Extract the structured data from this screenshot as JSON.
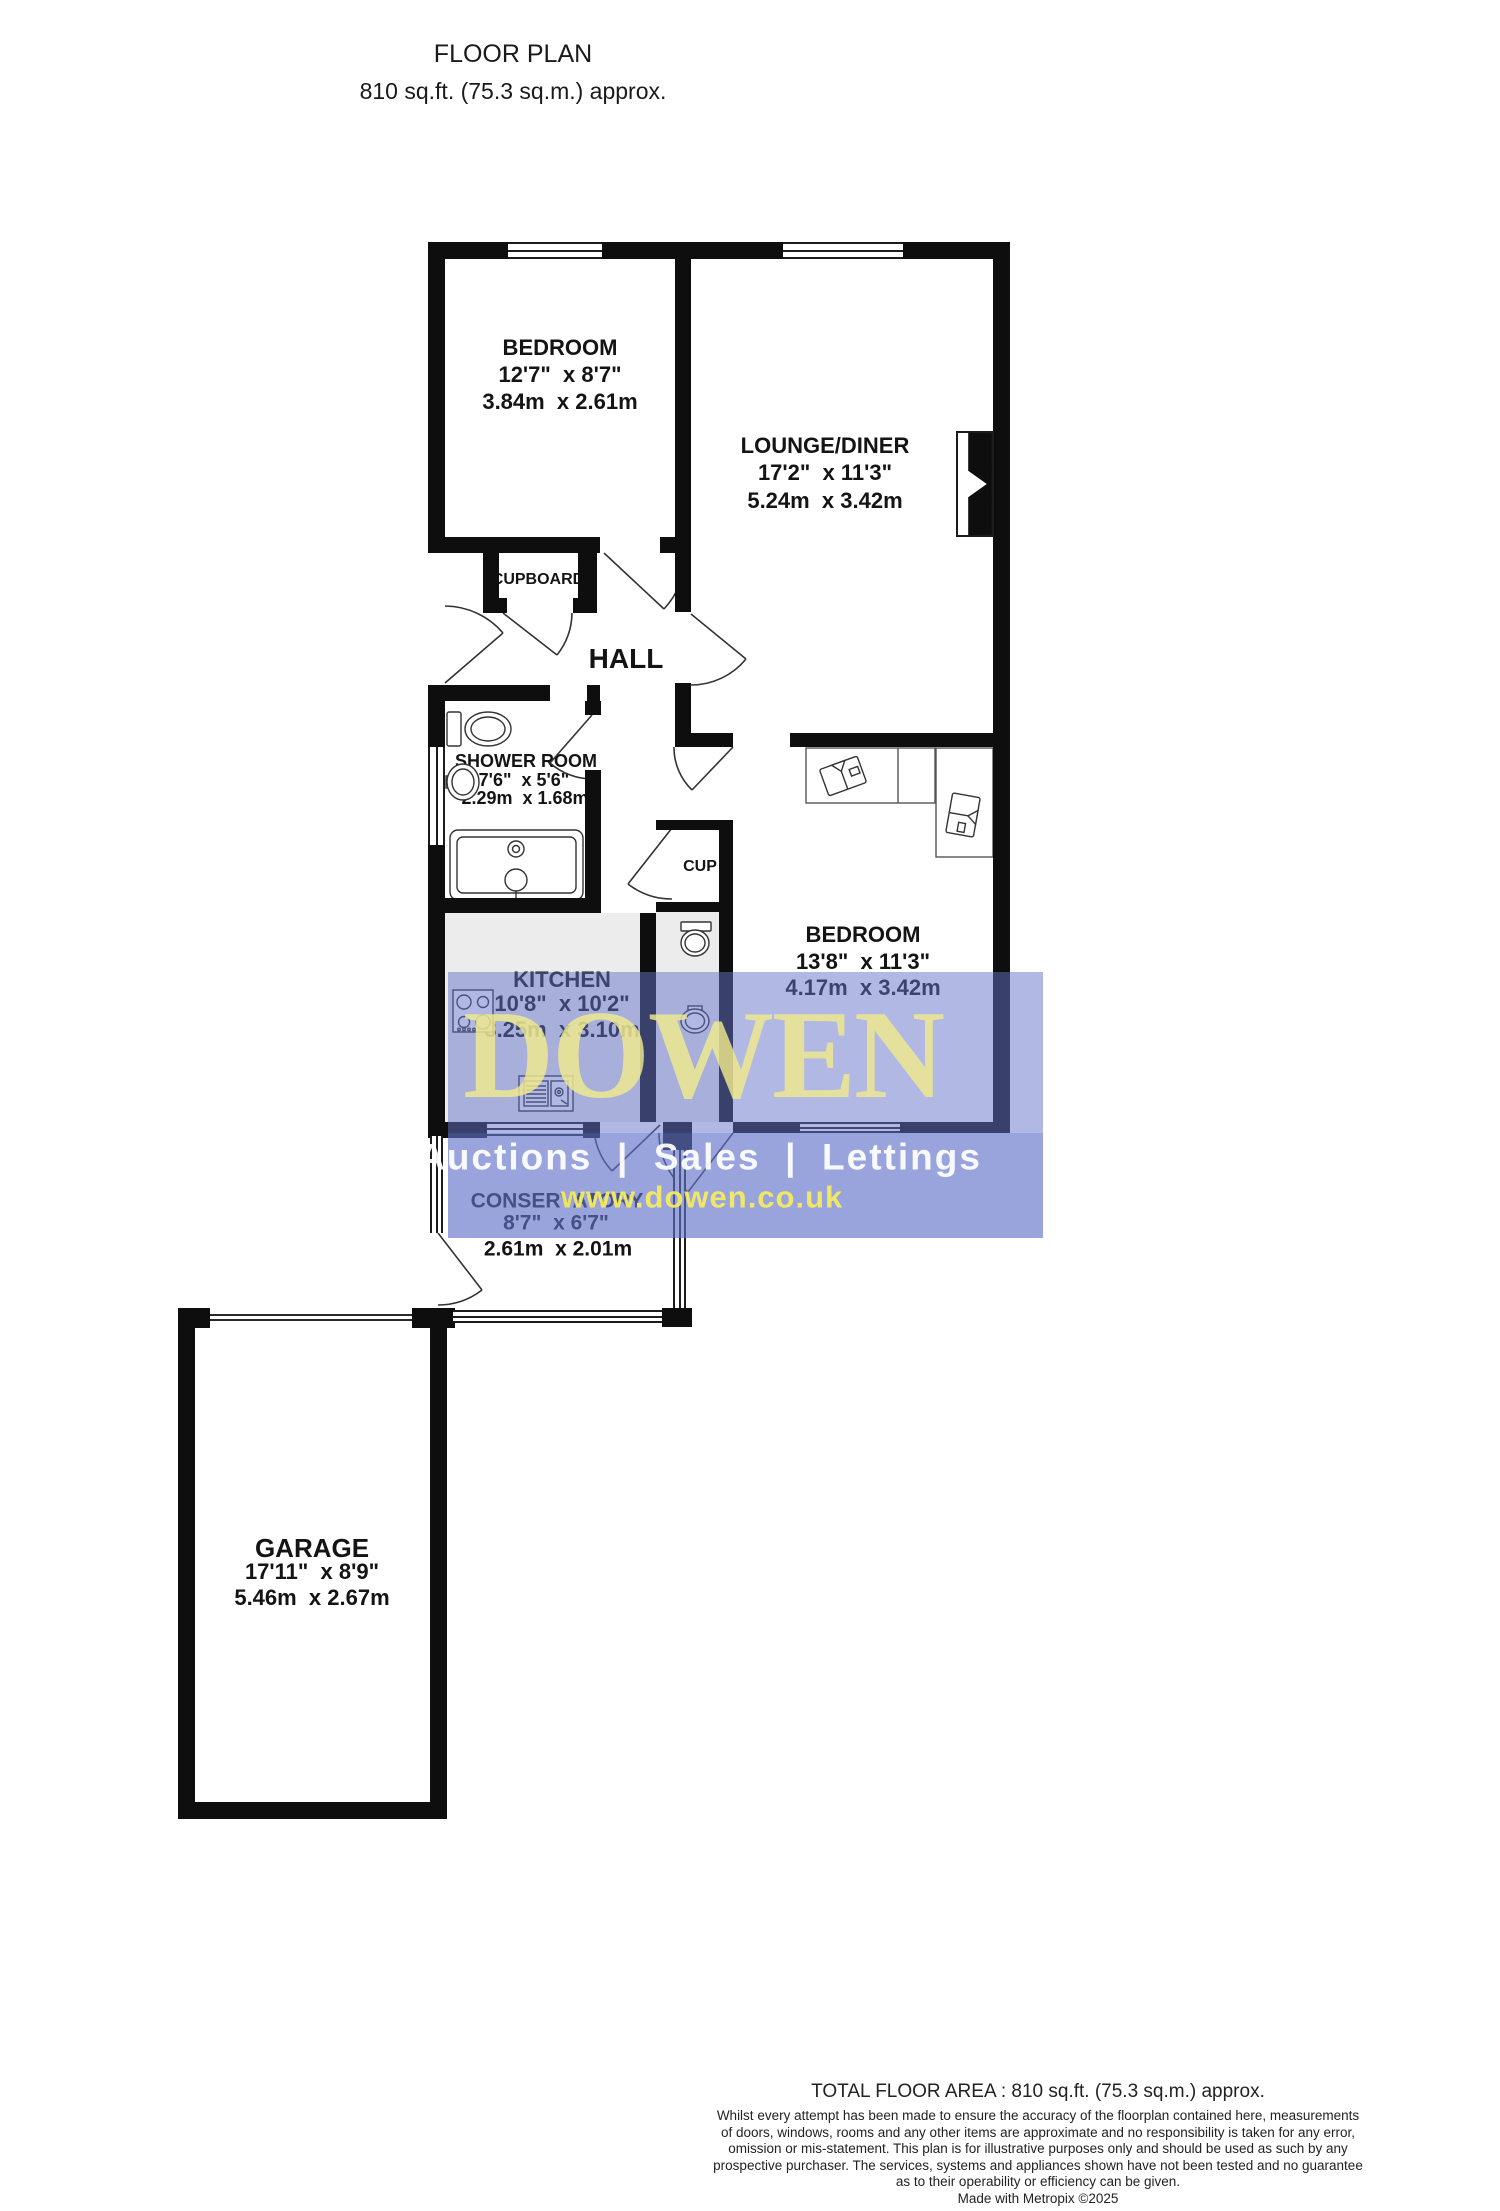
{
  "title": {
    "heading": "FLOOR PLAN",
    "subheading": "810 sq.ft. (75.3 sq.m.) approx."
  },
  "rooms": [
    {
      "name": "BEDROOM",
      "imperial": "12'7\"  x 8'7\"",
      "metric": "3.84m  x 2.61m"
    },
    {
      "name": "LOUNGE/DINER",
      "imperial": "17'2\"  x 11'3\"",
      "metric": "5.24m  x 3.42m"
    },
    {
      "name": "HALL"
    },
    {
      "name": "SHOWER ROOM",
      "imperial": "7'6\"  x 5'6\"",
      "metric": "2.29m  x 1.68m"
    },
    {
      "name": "KITCHEN",
      "imperial": "10'8\"  x 10'2\"",
      "metric": "3.25m  x 3.10m"
    },
    {
      "name": "BEDROOM",
      "imperial": "13'8\"  x 11'3\"",
      "metric": "4.17m  x 3.42m"
    },
    {
      "name": "CONSERVATORY",
      "imperial": "8'7\"  x 6'7\"",
      "metric": "2.61m  x 2.01m"
    },
    {
      "name": "GARAGE",
      "imperial": "17'11\"  x 8'9\"",
      "metric": "5.46m  x 2.67m"
    },
    {
      "name": "CUPBOARD"
    },
    {
      "name": "CUP"
    }
  ],
  "watermark": {
    "brand": "DOWEN",
    "tagline": "Auctions  |  Sales  |  Lettings",
    "website": "www.dowen.co.uk",
    "overlay_blue": "#6272c8",
    "brand_yellow": "#f0ea8e",
    "tagline_white": "#ffffff"
  },
  "footer": {
    "total": "TOTAL FLOOR AREA : 810 sq.ft. (75.3 sq.m.) approx.",
    "lines": [
      "Whilst every attempt has been made to ensure the accuracy of the floorplan contained here, measurements",
      "of doors, windows, rooms and any other items are approximate and no responsibility is taken for any error,",
      "omission or mis-statement. This plan is for illustrative purposes only and should be used as such by any",
      "prospective purchaser. The services, systems and appliances shown have not been tested and no guarantee",
      "as to their operability or efficiency can be given.",
      "Made with Metropix ©2025"
    ]
  }
}
